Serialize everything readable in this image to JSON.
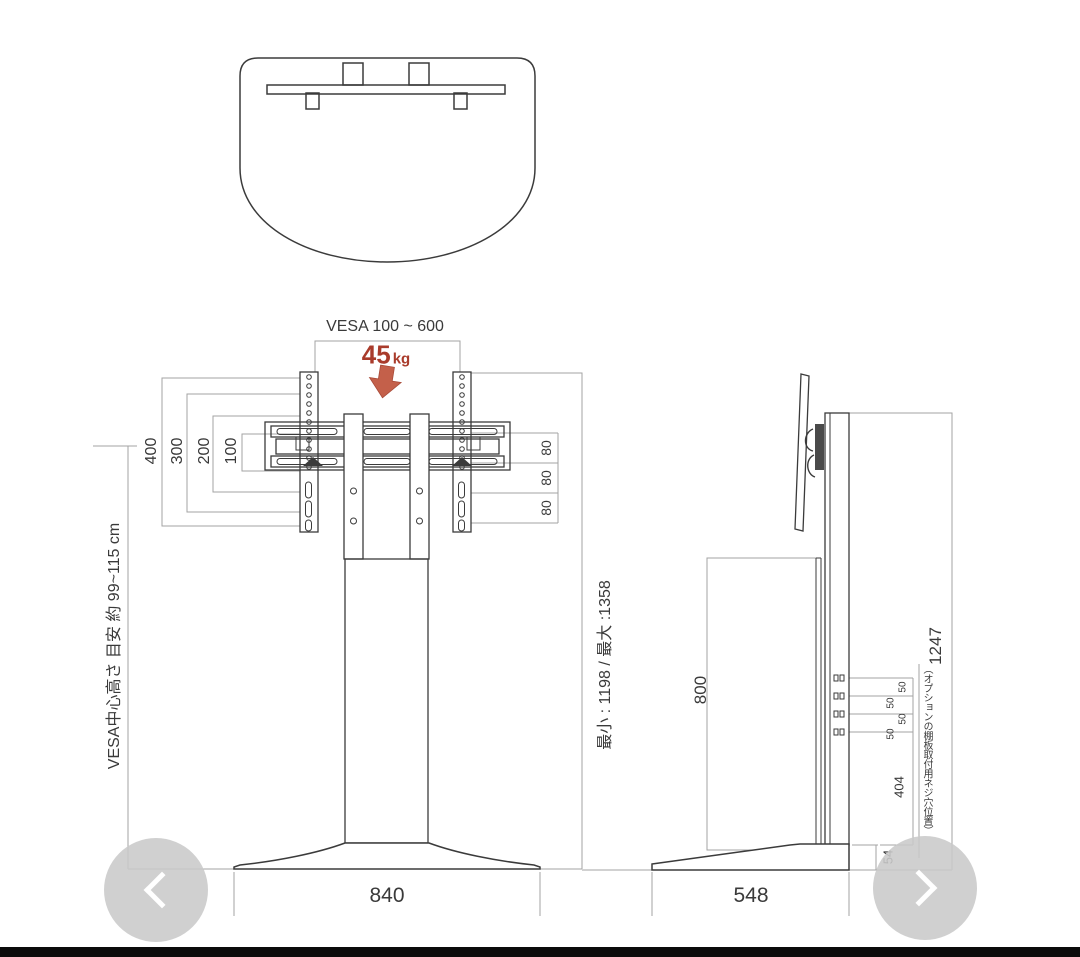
{
  "canvas": {
    "background": "#ffffff",
    "product_line_color": "#3b3b3b",
    "dimension_line_color": "#a3a3a3",
    "accent_red_text": "#a93b2b",
    "accent_red_arrow": "#c4604a",
    "carousel_color": "#cacaca",
    "bottom_bar_color": "#0b0b0b"
  },
  "front_view": {
    "vesa_range": "VESA 100 ~ 600",
    "load_value": "45",
    "load_unit": "kg",
    "left_dims": [
      "400",
      "300",
      "200",
      "100"
    ],
    "vesa_center_note": "VESA中心高さ 目安 約 99~115 cm",
    "height_range": "最小 : 1198 / 最大 :1358",
    "hole_pitch": [
      "80",
      "80",
      "80"
    ],
    "base_width": "840"
  },
  "side_view": {
    "total_height": "1247",
    "back_panel_height": "800",
    "screw_pitch": [
      "50",
      "50",
      "50",
      "50"
    ],
    "lower_span": "404",
    "base_height": "54",
    "base_depth": "548",
    "screw_note": "（オプションの棚板取付用ネジ穴位置）"
  },
  "carousel": {
    "prev": "previous image",
    "next": "next image"
  }
}
